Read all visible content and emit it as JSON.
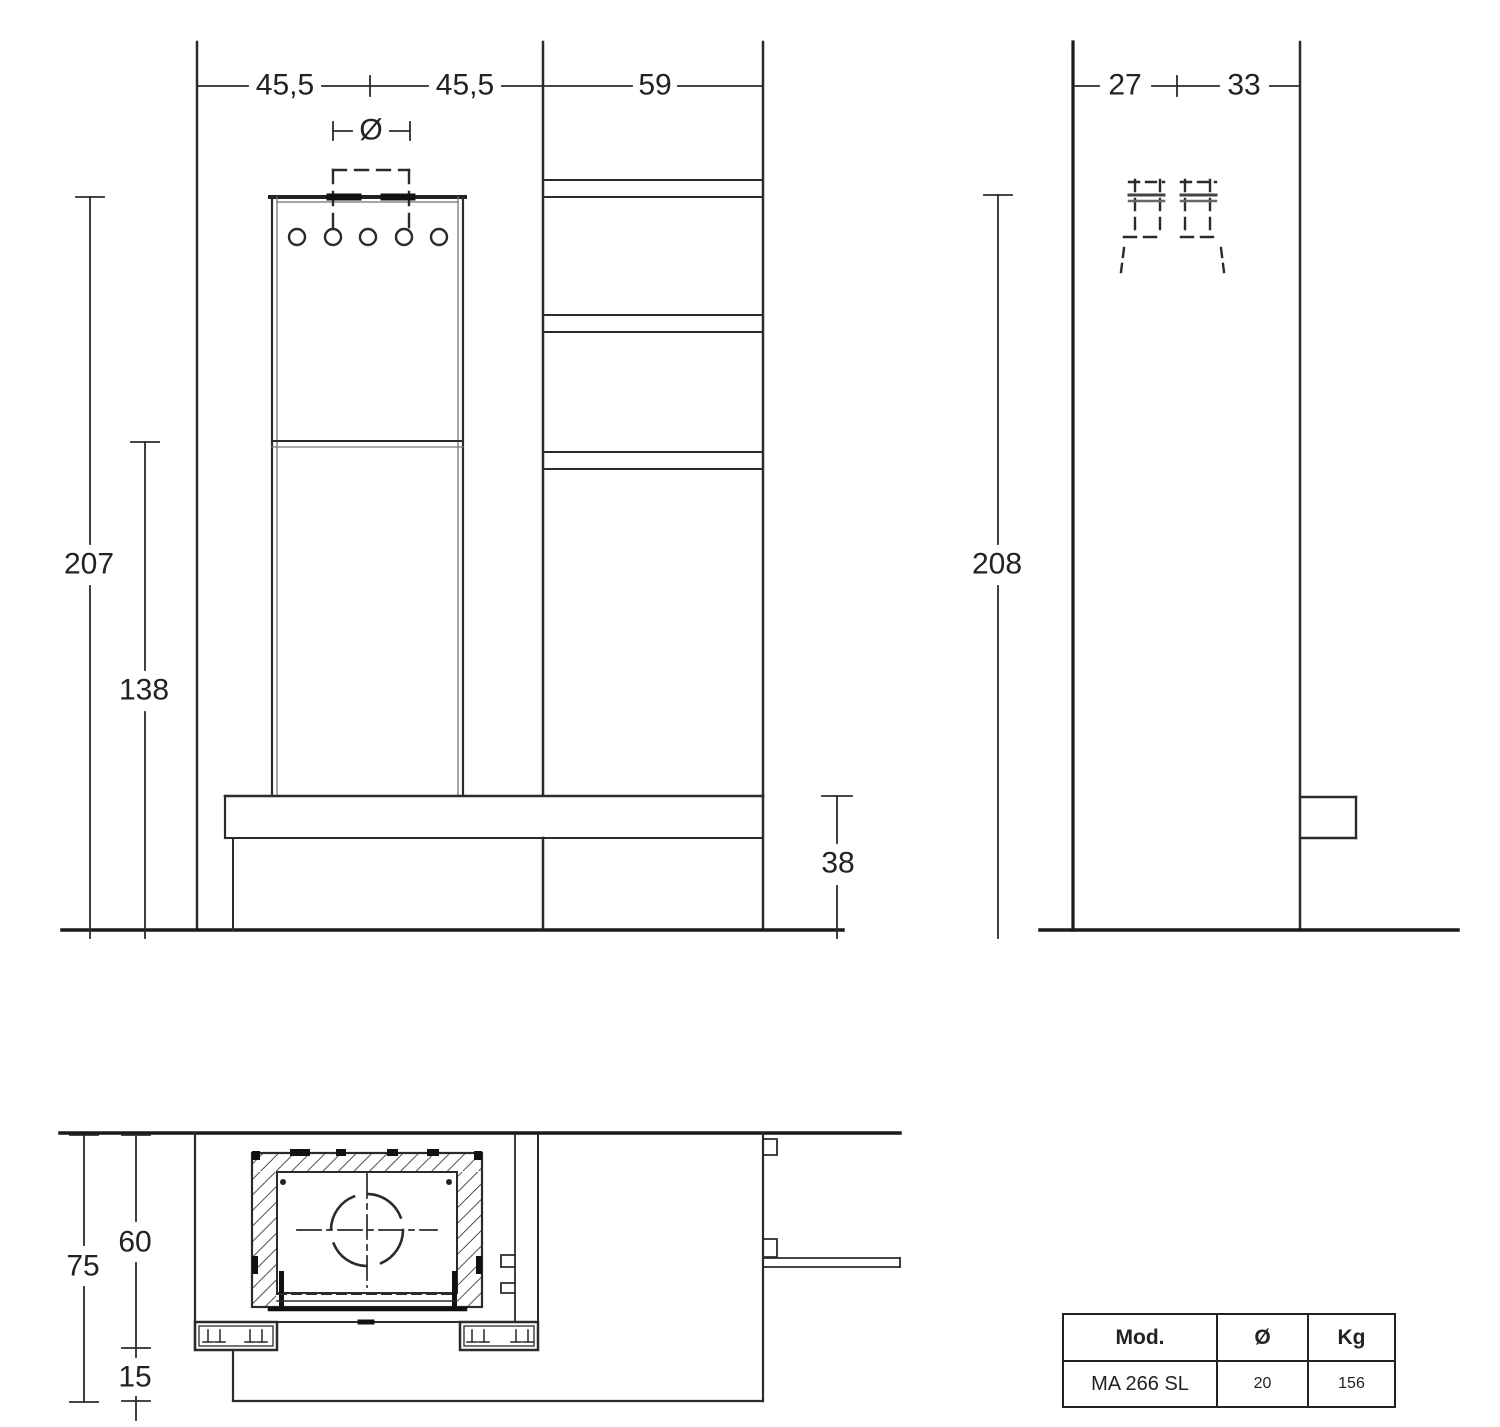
{
  "front_view": {
    "width_left": "45,5",
    "width_right": "45,5",
    "width_column": "59",
    "flue_symbol": "Ø",
    "height_total": "207",
    "height_shelf": "138",
    "height_bench": "38"
  },
  "side_view": {
    "depth_front": "27",
    "depth_back": "33",
    "height_total": "208"
  },
  "plan_view": {
    "depth_total": "75",
    "depth_niche": "60",
    "depth_bench": "15"
  },
  "spec_table": {
    "headers": [
      "Mod.",
      "Ø",
      "Kg"
    ],
    "row": [
      "MA 266 SL",
      "20",
      "156"
    ]
  }
}
